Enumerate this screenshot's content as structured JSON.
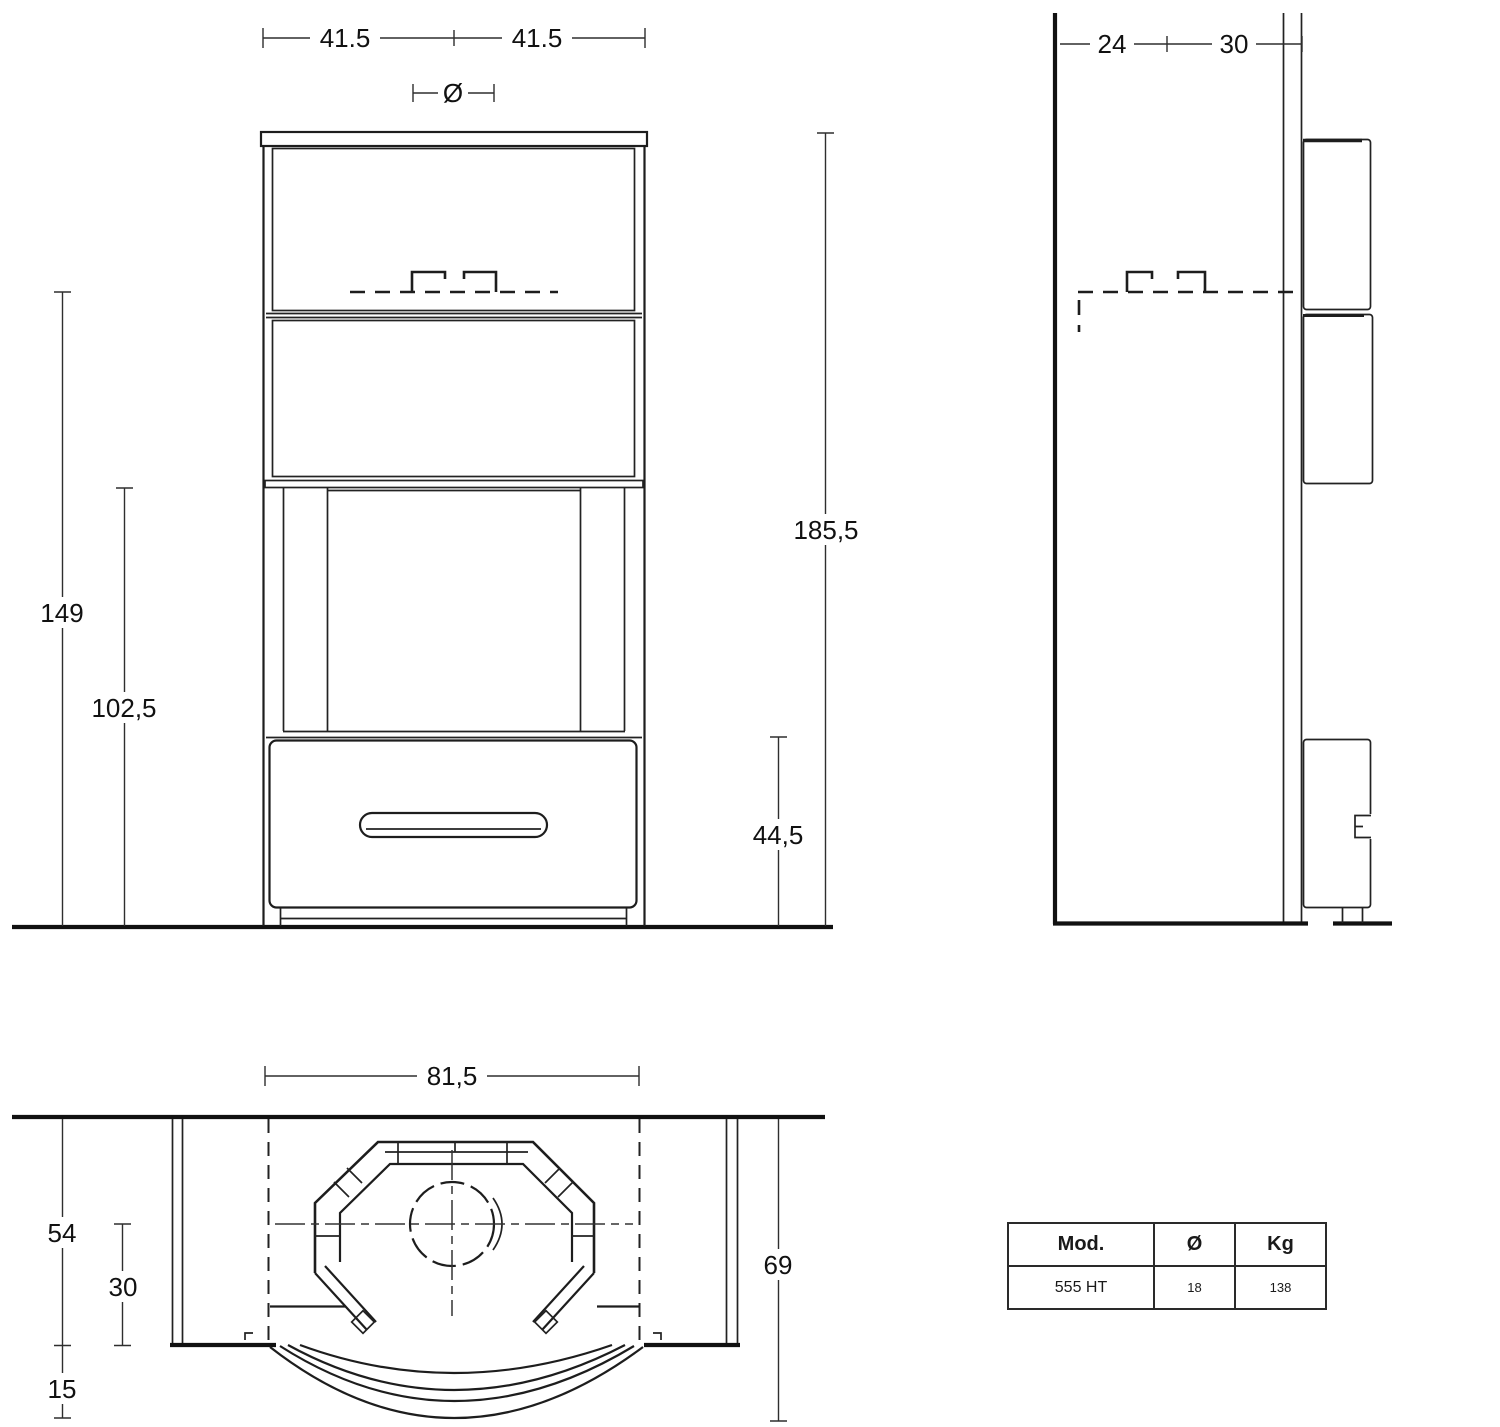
{
  "drawing": {
    "front_view": {
      "dim_half_width_left": "41.5",
      "dim_half_width_right": "41.5",
      "dim_flue_symbol": "Ø",
      "dim_height_hood": "149",
      "dim_height_firebox": "102,5",
      "dim_total_height": "185,5",
      "dim_base_height": "44,5"
    },
    "side_view": {
      "dim_depth_rear": "24",
      "dim_depth_front": "30"
    },
    "top_view": {
      "dim_width": "81,5",
      "dim_depth": "54",
      "dim_depth_center_front": "30",
      "dim_bow_depth": "15",
      "dim_total_depth": "69"
    }
  },
  "spec_table": {
    "header": {
      "model": "Mod.",
      "diameter": "Ø",
      "weight": "Kg"
    },
    "row": {
      "model": "555 HT",
      "diameter": "18",
      "weight": "138"
    }
  }
}
